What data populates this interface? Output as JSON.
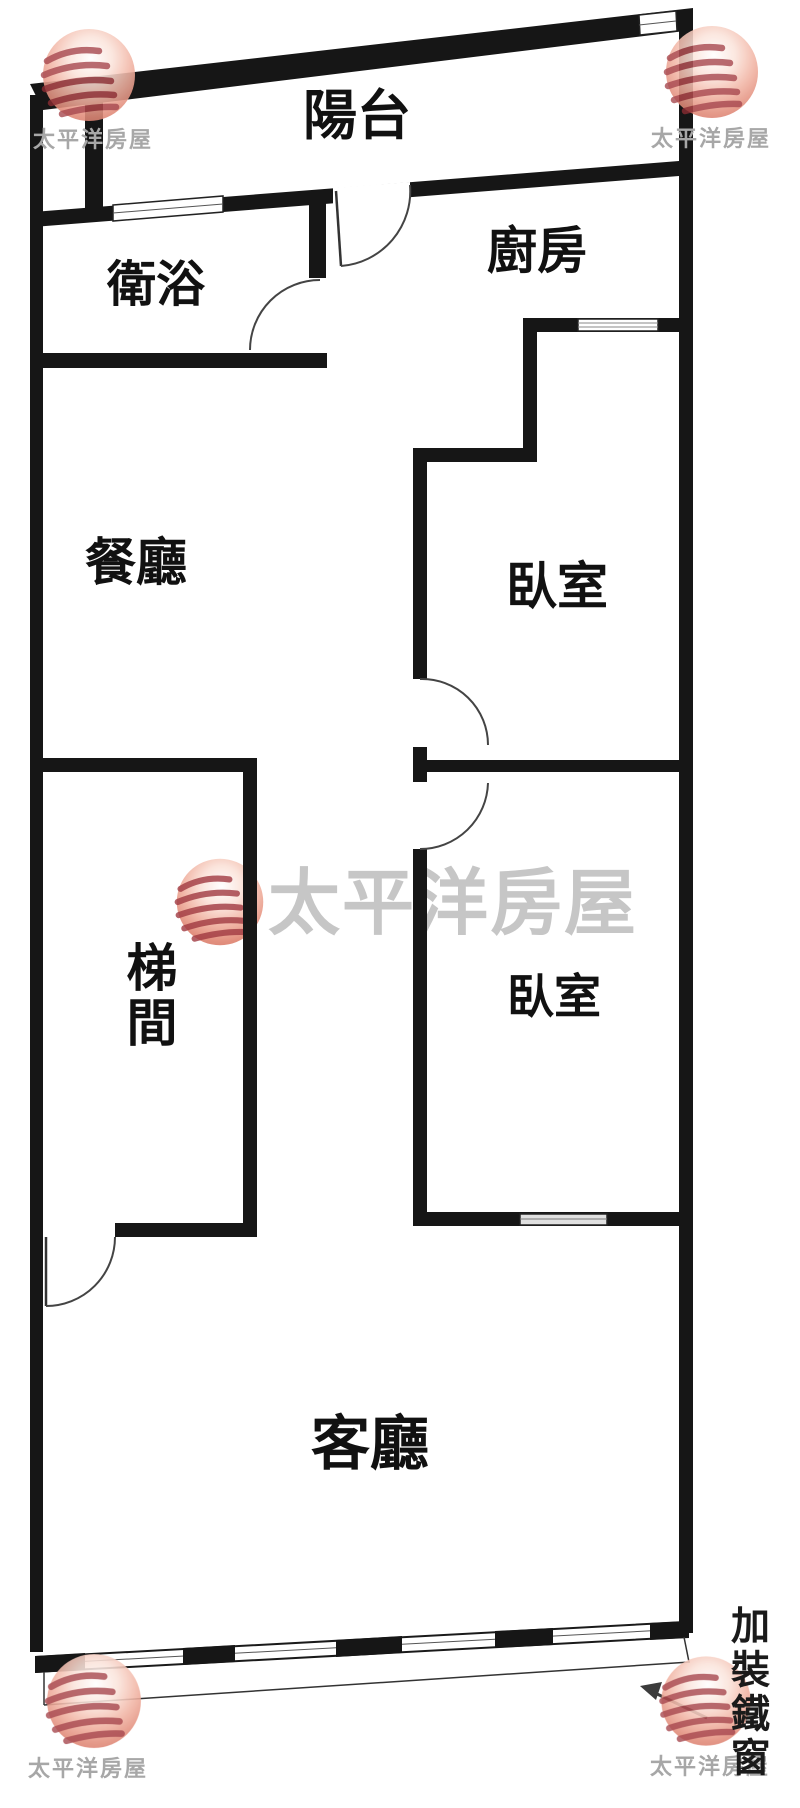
{
  "meta": {
    "type": "floor-plan"
  },
  "brand": {
    "name": "太平洋房屋"
  },
  "rooms": {
    "balcony": {
      "label": "陽台"
    },
    "bathroom": {
      "label": "衛浴"
    },
    "kitchen": {
      "label": "廚房"
    },
    "dining": {
      "label": "餐廳"
    },
    "bedroom_upper": {
      "label": "臥室"
    },
    "stairwell": {
      "label": "梯間"
    },
    "bedroom_lower": {
      "label": "臥室"
    },
    "living": {
      "label": "客廳"
    }
  },
  "annotations": {
    "iron_window": {
      "label": "加裝鐵窗"
    }
  },
  "colors": {
    "wall": "#161616",
    "label_text": "#111111",
    "watermark_text_small": "#a7a7a7",
    "watermark_text_large": "#c6c6c6",
    "logo_red": "#9c3038",
    "logo_sphere": "#e18a78",
    "arrow": "#3c3c3c"
  }
}
